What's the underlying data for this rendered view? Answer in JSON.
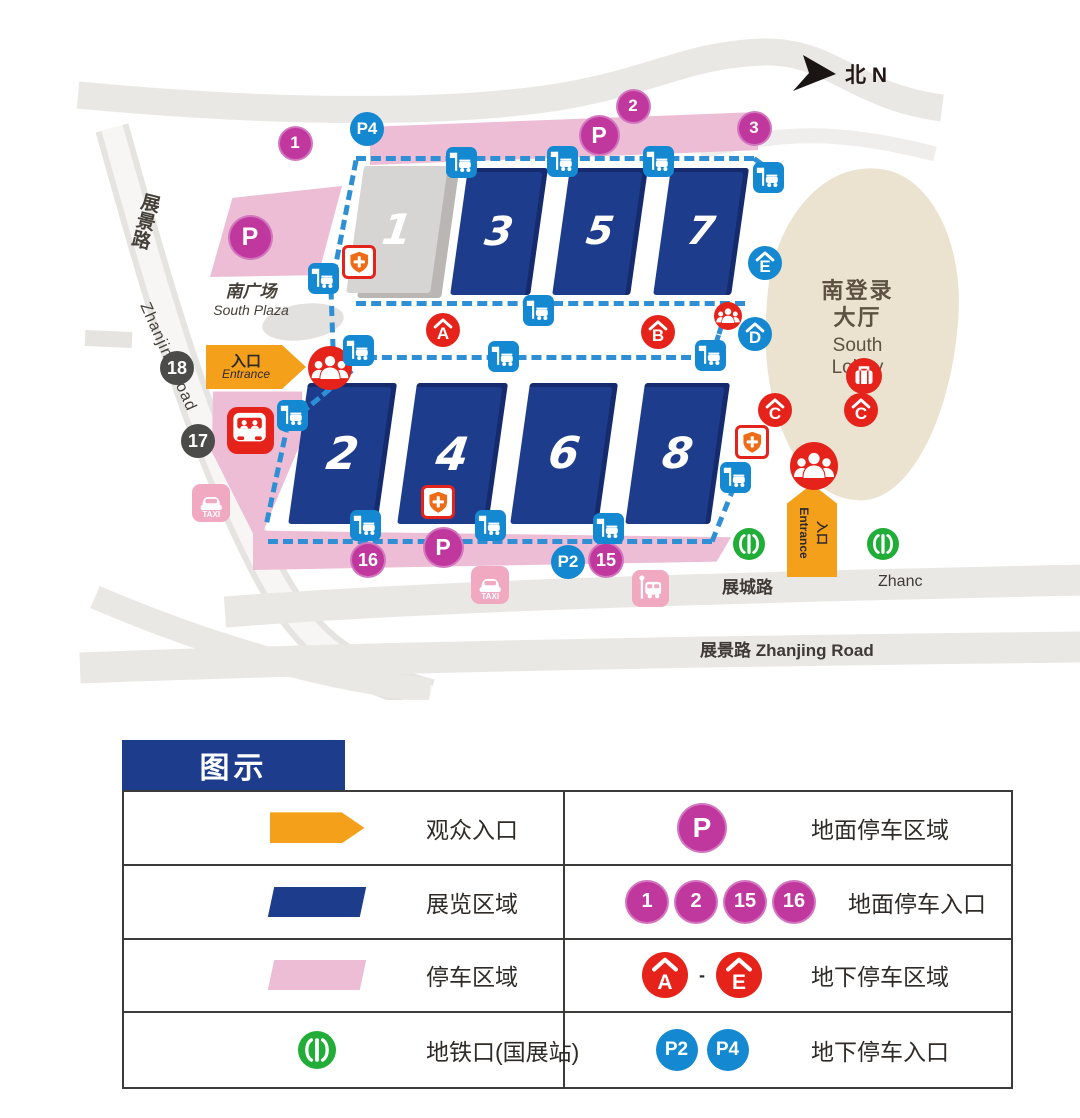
{
  "map": {
    "north_label": "北 N",
    "halls": [
      {
        "label": "1",
        "x": 364,
        "y": 166,
        "w": 84,
        "h": 127,
        "variant": "gray"
      },
      {
        "label": "3",
        "x": 468,
        "y": 168,
        "w": 80,
        "h": 127,
        "variant": "navy"
      },
      {
        "label": "5",
        "x": 570,
        "y": 168,
        "w": 78,
        "h": 127,
        "variant": "navy"
      },
      {
        "label": "7",
        "x": 671,
        "y": 168,
        "w": 78,
        "h": 127,
        "variant": "navy"
      },
      {
        "label": "2",
        "x": 308,
        "y": 383,
        "w": 89,
        "h": 141,
        "variant": "navy"
      },
      {
        "label": "4",
        "x": 417,
        "y": 383,
        "w": 91,
        "h": 141,
        "variant": "navy"
      },
      {
        "label": "6",
        "x": 530,
        "y": 383,
        "w": 88,
        "h": 141,
        "variant": "navy"
      },
      {
        "label": "8",
        "x": 645,
        "y": 383,
        "w": 85,
        "h": 141,
        "variant": "navy"
      }
    ],
    "areas": {
      "south_plaza_zh": "南广场",
      "south_plaza_en": "South Plaza",
      "south_lobby_zh1": "南登录",
      "south_lobby_zh2": "大厅",
      "south_lobby_en1": "South",
      "south_lobby_en2": "Lobby"
    },
    "roads": {
      "zhanjing_left_zh": "展景路",
      "zhanjing_left_en": "Zhanjing Road",
      "zhancheng_zh": "展城路",
      "zhancheng_en_partial": "Zhanc",
      "zhanjing_bottom": "展景路  Zhanjing Road"
    },
    "entrances": {
      "left_zh": "入口",
      "left_en": "Entrance",
      "bottom_zh": "入口",
      "bottom_en": "Entrance"
    },
    "markers": [
      {
        "name": "ground-parking-entrance-1",
        "type": "num-pink",
        "label": "1",
        "x": 295,
        "y": 143,
        "d": 31
      },
      {
        "name": "underground-parking-entrance-p4",
        "type": "num-blue",
        "label": "P4",
        "x": 367,
        "y": 129,
        "d": 34
      },
      {
        "name": "ground-parking-entrance-2",
        "type": "num-pink",
        "label": "2",
        "x": 633,
        "y": 106,
        "d": 31
      },
      {
        "name": "ground-parking-area-top",
        "type": "p-pink",
        "label": "P",
        "x": 599,
        "y": 135,
        "d": 37
      },
      {
        "name": "ground-parking-entrance-3",
        "type": "num-pink",
        "label": "3",
        "x": 754,
        "y": 128,
        "d": 31
      },
      {
        "name": "ground-parking-area-plaza",
        "type": "p-pink",
        "label": "P",
        "x": 250,
        "y": 237,
        "d": 41
      },
      {
        "name": "gate-18",
        "type": "num-dark",
        "label": "18",
        "x": 177,
        "y": 368,
        "d": 34
      },
      {
        "name": "gate-17",
        "type": "num-dark",
        "label": "17",
        "x": 198,
        "y": 441,
        "d": 34
      },
      {
        "name": "ground-parking-entrance-16",
        "type": "num-pink",
        "label": "16",
        "x": 368,
        "y": 560,
        "d": 32
      },
      {
        "name": "ground-parking-area-bottom",
        "type": "p-pink",
        "label": "P",
        "x": 443,
        "y": 547,
        "d": 37
      },
      {
        "name": "underground-parking-entrance-p2",
        "type": "num-blue",
        "label": "P2",
        "x": 568,
        "y": 562,
        "d": 34
      },
      {
        "name": "ground-parking-entrance-15",
        "type": "num-pink",
        "label": "15",
        "x": 606,
        "y": 560,
        "d": 32
      },
      {
        "name": "underground-parking-area-a",
        "type": "roof-red",
        "label": "A",
        "x": 443,
        "y": 330,
        "d": 34
      },
      {
        "name": "underground-parking-area-b",
        "type": "roof-red",
        "label": "B",
        "x": 658,
        "y": 332,
        "d": 34
      },
      {
        "name": "underground-parking-area-c1",
        "type": "roof-red",
        "label": "C",
        "x": 775,
        "y": 410,
        "d": 34
      },
      {
        "name": "underground-parking-area-c2",
        "type": "roof-red",
        "label": "C",
        "x": 861,
        "y": 410,
        "d": 34
      },
      {
        "name": "underground-parking-area-d",
        "type": "roof-blue",
        "label": "D",
        "x": 755,
        "y": 334,
        "d": 34
      },
      {
        "name": "underground-parking-area-e",
        "type": "roof-blue",
        "label": "E",
        "x": 765,
        "y": 263,
        "d": 34
      },
      {
        "name": "visitor-entrance-west",
        "type": "people",
        "x": 330,
        "y": 368,
        "d": 44
      },
      {
        "name": "visitor-entrance-south",
        "type": "people",
        "x": 814,
        "y": 466,
        "d": 48
      },
      {
        "name": "visitor-entrance-mid",
        "type": "people",
        "x": 728,
        "y": 316,
        "d": 28
      },
      {
        "name": "luggage-deposit",
        "type": "luggage",
        "x": 864,
        "y": 376,
        "d": 36
      },
      {
        "name": "shuttle-bus-terminal",
        "type": "bus-red",
        "x": 250,
        "y": 430,
        "d": 47
      },
      {
        "name": "taxi-stand-west",
        "type": "taxi",
        "x": 211,
        "y": 503,
        "d": 38
      },
      {
        "name": "taxi-stand-south",
        "type": "taxi",
        "x": 490,
        "y": 585,
        "d": 38
      },
      {
        "name": "bus-stop-south",
        "type": "busstop-pink",
        "x": 650,
        "y": 588,
        "d": 37
      },
      {
        "name": "metro-exit-west",
        "type": "metro",
        "x": 749,
        "y": 544,
        "d": 32
      },
      {
        "name": "metro-exit-east",
        "type": "metro",
        "x": 883,
        "y": 544,
        "d": 32
      },
      {
        "name": "medical-point-hall1",
        "type": "shield",
        "x": 359,
        "y": 262,
        "d": 34
      },
      {
        "name": "medical-point-hall4",
        "type": "shield",
        "x": 438,
        "y": 502,
        "d": 34
      },
      {
        "name": "medical-point-lobby",
        "type": "shield",
        "x": 752,
        "y": 442,
        "d": 34
      },
      {
        "name": "shuttle-stop",
        "type": "shuttle",
        "x": 461,
        "y": 162,
        "d": 31
      },
      {
        "name": "shuttle-stop",
        "type": "shuttle",
        "x": 562,
        "y": 161,
        "d": 31
      },
      {
        "name": "shuttle-stop",
        "type": "shuttle",
        "x": 658,
        "y": 161,
        "d": 31
      },
      {
        "name": "shuttle-stop",
        "type": "shuttle",
        "x": 768,
        "y": 177,
        "d": 31
      },
      {
        "name": "shuttle-stop",
        "type": "shuttle",
        "x": 538,
        "y": 310,
        "d": 31
      },
      {
        "name": "shuttle-stop",
        "type": "shuttle",
        "x": 503,
        "y": 356,
        "d": 31
      },
      {
        "name": "shuttle-stop",
        "type": "shuttle",
        "x": 710,
        "y": 355,
        "d": 31
      },
      {
        "name": "shuttle-stop",
        "type": "shuttle",
        "x": 323,
        "y": 278,
        "d": 31
      },
      {
        "name": "shuttle-stop",
        "type": "shuttle",
        "x": 358,
        "y": 350,
        "d": 31
      },
      {
        "name": "shuttle-stop",
        "type": "shuttle",
        "x": 292,
        "y": 415,
        "d": 31
      },
      {
        "name": "shuttle-stop",
        "type": "shuttle",
        "x": 365,
        "y": 525,
        "d": 31
      },
      {
        "name": "shuttle-stop",
        "type": "shuttle",
        "x": 490,
        "y": 525,
        "d": 31
      },
      {
        "name": "shuttle-stop",
        "type": "shuttle",
        "x": 608,
        "y": 528,
        "d": 31
      },
      {
        "name": "shuttle-stop",
        "type": "shuttle",
        "x": 735,
        "y": 477,
        "d": 31
      }
    ],
    "dashes": [
      {
        "x": 356,
        "y": 156,
        "len": 398,
        "deg": 0
      },
      {
        "x": 754,
        "y": 156,
        "len": 27,
        "deg": 36
      },
      {
        "x": 356,
        "y": 158,
        "len": 131,
        "deg": 101
      },
      {
        "x": 331,
        "y": 287,
        "len": 76,
        "deg": 88
      },
      {
        "x": 356,
        "y": 301,
        "len": 389,
        "deg": 0
      },
      {
        "x": 352,
        "y": 355,
        "len": 354,
        "deg": 0
      },
      {
        "x": 722,
        "y": 322,
        "len": 32,
        "deg": 108
      },
      {
        "x": 352,
        "y": 368,
        "len": 81,
        "deg": 140
      },
      {
        "x": 288,
        "y": 420,
        "len": 102,
        "deg": 102
      },
      {
        "x": 268,
        "y": 539,
        "len": 444,
        "deg": 0
      },
      {
        "x": 712,
        "y": 539,
        "len": 59,
        "deg": -68
      }
    ]
  },
  "legend": {
    "title": "图示",
    "left_rows": [
      {
        "icon": "entrance-arrow",
        "label": "观众入口"
      },
      {
        "icon": "exhibition-area",
        "label": "展览区域"
      },
      {
        "icon": "parking-area",
        "label": "停车区域"
      },
      {
        "icon": "metro",
        "label": "地铁口(国展站)"
      }
    ],
    "right_rows": [
      {
        "style": "p-pink",
        "icons": [
          "P"
        ],
        "label": "地面停车区域"
      },
      {
        "style": "num-pink",
        "icons": [
          "1",
          "2",
          "15",
          "16"
        ],
        "label": "地面停车入口"
      },
      {
        "style": "roof-red",
        "icons": [
          "A",
          "E"
        ],
        "joiner": "-",
        "label": "地下停车区域"
      },
      {
        "style": "num-blue",
        "icons": [
          "P2",
          "P4"
        ],
        "label": "地下停车入口"
      }
    ]
  },
  "colors": {
    "hall_navy": "#1e3c8c",
    "hall_gray": "#d7d5d3",
    "parking_pink": "#ecbdd5",
    "magenta": "#c0389e",
    "blue": "#1488d0",
    "red": "#e5231b",
    "orange_entrance": "#f5a01b",
    "metro_green": "#22ac38",
    "lobby_beige": "#ebe2cf",
    "route_dash_blue": "#2e8fd5",
    "road_gray": "#eae8e5",
    "dark_circle": "#4b4b49",
    "shield_orange": "#ee6c17"
  }
}
